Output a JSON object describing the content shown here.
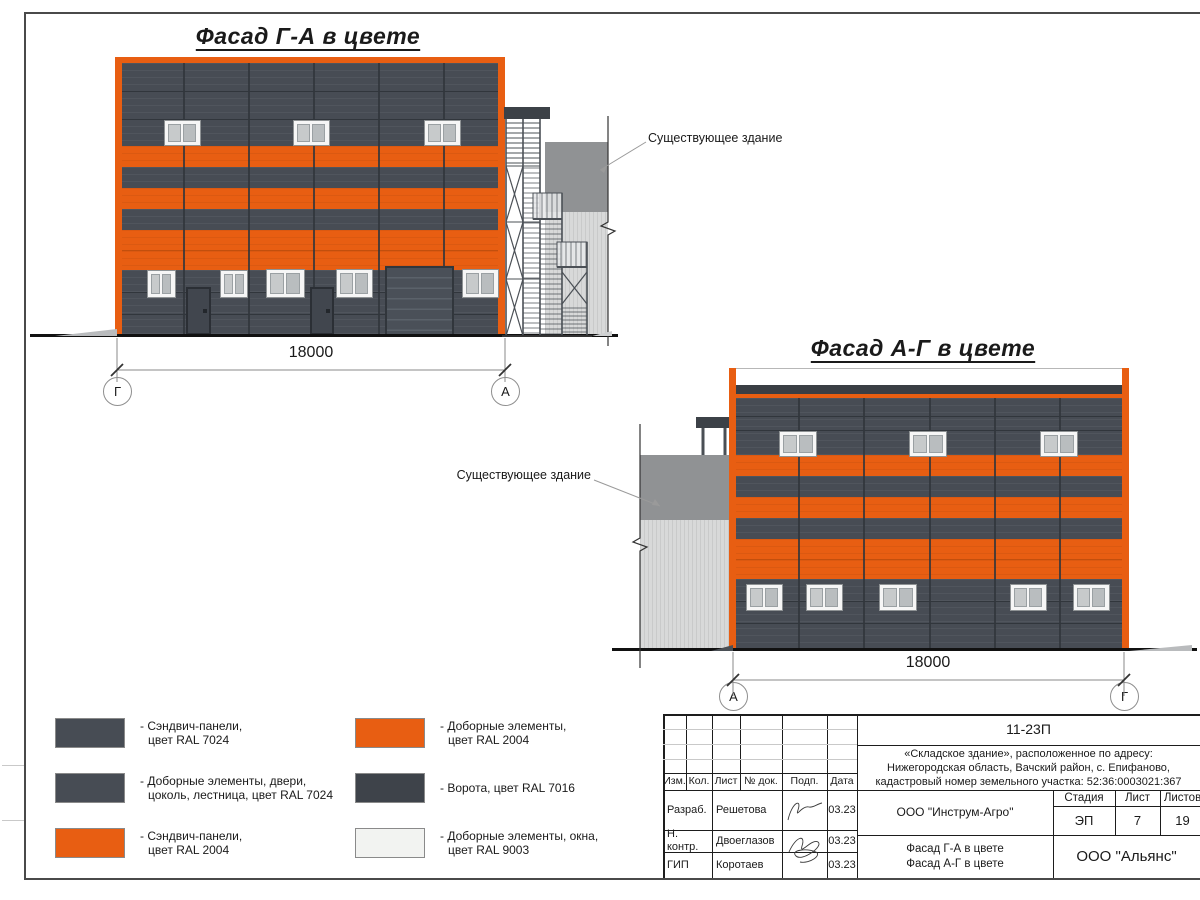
{
  "sheet": {
    "titles": {
      "left": "Фасад Г-А в цвете",
      "right": "Фасад А-Г в цвете"
    },
    "dimension": "18000",
    "axes": {
      "left_start": "Г",
      "left_end": "А",
      "right_start": "А",
      "right_end": "Г"
    },
    "existing_building_label": "Существующее здание",
    "watermark": {
      "big": "пс",
      "small": "компания"
    }
  },
  "colors": {
    "ral7024": "#474c54",
    "ral7024_seam": "#31363c",
    "ral2004": "#e85e12",
    "ral2004_seam": "#c24f0d",
    "ral7016": "#3e434a",
    "ral9003": "#f2f3f1",
    "door": "#41464e",
    "gate": "#4a5058",
    "window_frame": "#f6f6f6",
    "glass_a": "#c7cacb",
    "glass_b": "#b9bdbf",
    "existing_dark": "#909294",
    "existing_light": "#d8d9d9",
    "ground": "#111111"
  },
  "legend": {
    "items": [
      {
        "color_key": "ral7024",
        "line1": "- Сэндвич-панели,",
        "line2": "цвет RAL 7024"
      },
      {
        "color_key": "ral7024",
        "line1": "- Доборные элементы, двери,",
        "line2": "цоколь, лестница, цвет RAL 7024"
      },
      {
        "color_key": "ral2004",
        "line1": "- Сэндвич-панели,",
        "line2": "цвет RAL 2004"
      },
      {
        "color_key": "ral2004",
        "line1": "- Доборные элементы,",
        "line2": "цвет RAL 2004"
      },
      {
        "color_key": "ral7016",
        "line1": "- Ворота, цвет RAL 7016",
        "line2": ""
      },
      {
        "color_key": "ral9003",
        "line1": "- Доборные элементы, окна,",
        "line2": "цвет RAL 9003"
      }
    ]
  },
  "titleblock": {
    "doc_number": "11-23П",
    "address_line1": "«Складское здание», расположенное по адресу:",
    "address_line2": "Нижегородская область, Вачский район, с. Епифаново,",
    "address_line3": "кадастровый номер земельного участка: 52:36:0003021:367",
    "header_cols": [
      "Изм.",
      "Кол.",
      "Лист",
      "№ док.",
      "Подп.",
      "Дата"
    ],
    "rows": [
      {
        "role": "Разраб.",
        "name": "Решетова",
        "date": "03.23"
      },
      {
        "role": "Н. контр.",
        "name": "Двоеглазов",
        "date": "03.23"
      },
      {
        "role": "ГИП",
        "name": "Коротаев",
        "date": "03.23"
      }
    ],
    "company": "ООО \"Инструм-Агро\"",
    "stage_label": "Стадия",
    "sheet_label": "Лист",
    "sheets_label": "Листов",
    "stage": "ЭП",
    "sheet_no": "7",
    "sheets_total": "19",
    "drawing_name_line1": "Фасад Г-А в цвете",
    "drawing_name_line2": "Фасад А-Г в цвете",
    "org": "ООО \"Альянс\""
  }
}
